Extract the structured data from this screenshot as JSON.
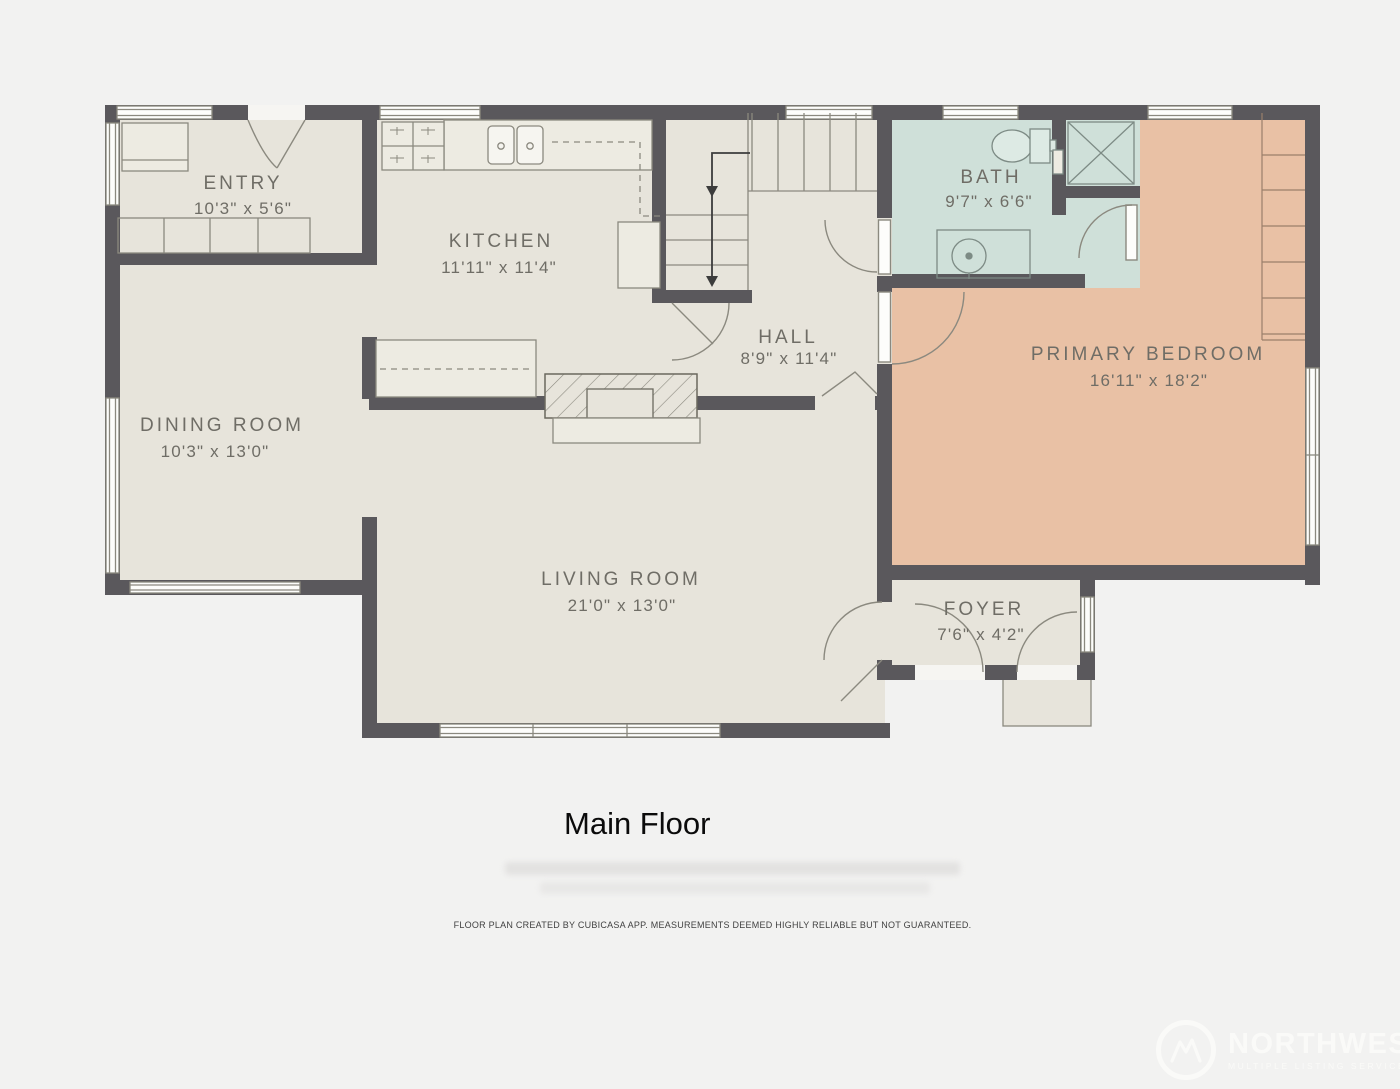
{
  "page": {
    "title": "Main Floor",
    "disclaimer": "FLOOR PLAN CREATED BY CUBICASA APP. MEASUREMENTS DEEMED HIGHLY RELIABLE BUT NOT GUARANTEED.",
    "background": "#f2f2f1"
  },
  "colors": {
    "wall": "#5a585c",
    "floor": "#e7e4db",
    "bath_floor": "#cfe0d9",
    "bedroom_floor": "#e9c1a5",
    "fixture_line": "#8b897f",
    "label_text": "#6f6d66"
  },
  "rooms": {
    "entry": {
      "name": "ENTRY",
      "dims": "10'3\" x 5'6\""
    },
    "kitchen": {
      "name": "KITCHEN",
      "dims": "11'11\" x 11'4\""
    },
    "hall": {
      "name": "HALL",
      "dims": "8'9\" x 11'4\""
    },
    "bath": {
      "name": "BATH",
      "dims": "9'7\" x 6'6\""
    },
    "primary_bedroom": {
      "name": "PRIMARY BEDROOM",
      "dims": "16'11\" x 18'2\""
    },
    "dining_room": {
      "name": "DINING ROOM",
      "dims": "10'3\" x 13'0\""
    },
    "living_room": {
      "name": "LIVING ROOM",
      "dims": "21'0\" x 13'0\""
    },
    "foyer": {
      "name": "FOYER",
      "dims": "7'6\" x 4'2\""
    }
  },
  "watermark": {
    "brand": "NORTHWEST",
    "tagline": "MULTIPLE LISTING SERVICE"
  }
}
